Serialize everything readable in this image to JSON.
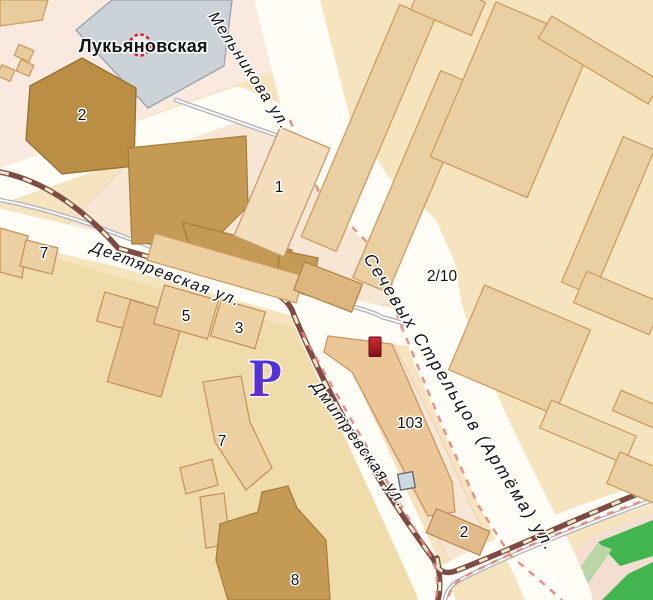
{
  "metro": {
    "label": "Лукьяновская"
  },
  "streets": {
    "melnikova": "Мельникова ул.",
    "sichovykh": "Сечевых Стрельцов (Артёма) ул.",
    "dehtiarivska": "Дегтяревская ул.",
    "dmytrivska": "Дмитревская ул."
  },
  "buildings": {
    "topleft_2": "2",
    "block1_1": "1",
    "left_7": "7",
    "b5": "5",
    "b3": "3",
    "mid_7": "7",
    "b103": "103",
    "b2_10": "2/10",
    "pink_2": "2",
    "b8": "8"
  },
  "icons": {
    "parking_label": "Р",
    "metro_icon": "dashed-red-circle",
    "marker": "red-building-marker",
    "poi": "entrance-square"
  },
  "colors": {
    "background": "#f6e4bf",
    "block_pink_top": "#f9e9df",
    "block_pink_mid": "#f8e6d4",
    "district_yellow": "#f0dbaa",
    "building_tan": "#e9cfa2",
    "building_dark": "#c49a54",
    "building_gold": "#ba8e44",
    "building_light": "#f3ddbb",
    "metro_building": "#ccd3d8",
    "road": "#fffdf6",
    "tram_line": "#7d4b43",
    "tram_dash": "#ece9c8",
    "rail_gray": "#b4b4bd",
    "route_red": "#e8837a",
    "park_green": "#42b54e",
    "park_light_green": "#b9d6a4",
    "park_pink": "#f4ded2",
    "parking_blue": "#4636d6",
    "marker_red": "#b51f2c",
    "metro_red": "#e31e24"
  }
}
